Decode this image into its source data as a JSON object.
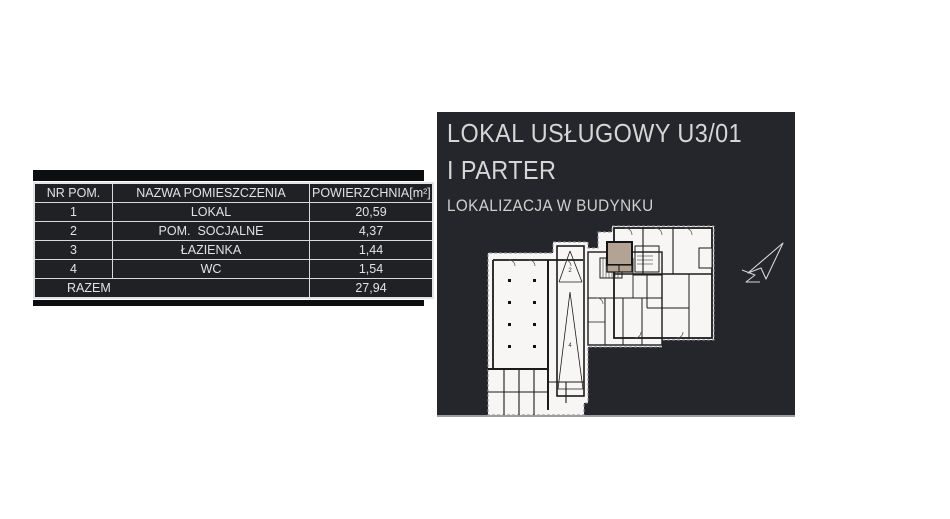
{
  "table": {
    "headers": [
      "NR POM.",
      "NAZWA POMIESZCZENIA",
      "POWIERZCHNIA[m²]"
    ],
    "rows": [
      {
        "nr": "1",
        "name": "LOKAL",
        "area": "20,59"
      },
      {
        "nr": "2",
        "name": "POM.  SOCJALNE",
        "area": "4,37"
      },
      {
        "nr": "3",
        "name": "ŁAZIENKA",
        "area": "1,44"
      },
      {
        "nr": "4",
        "name": "WC",
        "area": "1,54"
      }
    ],
    "total_label": "RAZEM",
    "total_value": "27,94"
  },
  "panel": {
    "title_line1": "LOKAL USŁUGOWY U3/01",
    "title_line2": "I PARTER",
    "subtitle": "LOKALIZACJA W BUDYNKU",
    "plan": {
      "ramp_label_top": "2",
      "ramp_label_bottom": "4",
      "icons": [
        "north-arrow-icon"
      ]
    },
    "colors": {
      "panel_bg": "#24262b",
      "highlight_unit": "#b2a395",
      "plan_paper": "#f7f6f4",
      "table_border": "#d9d9d9",
      "bar": "#0d0e10"
    }
  }
}
